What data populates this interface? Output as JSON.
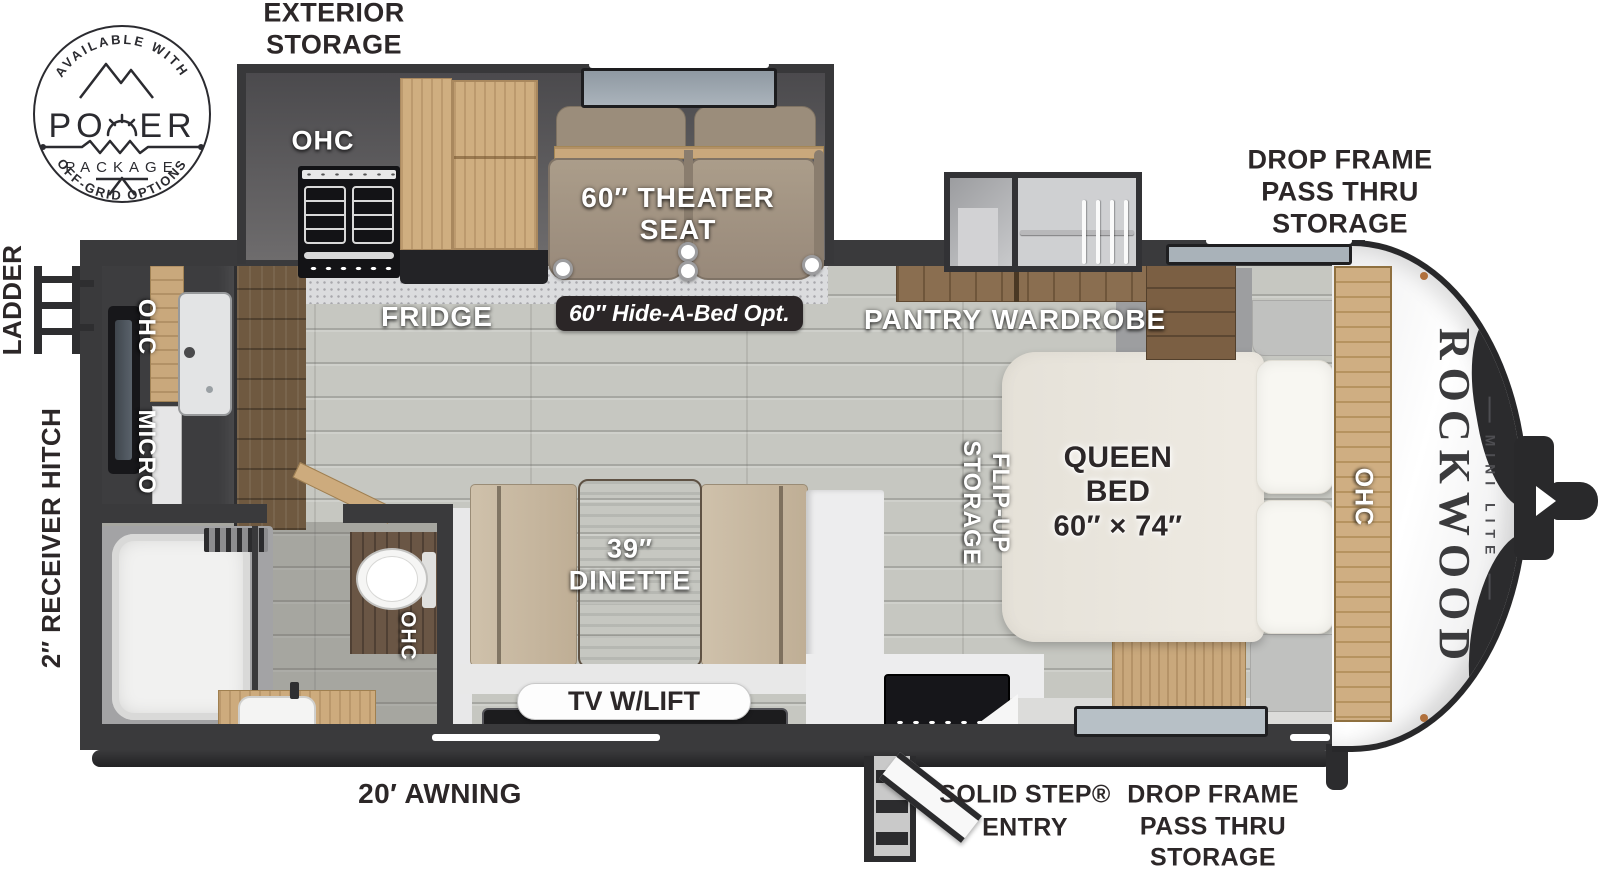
{
  "logo": {
    "arc_top": "AVAILABLE WITH",
    "power_left": "PO",
    "power_right": "ER",
    "package": "PACKAGE",
    "arc_bottom": "OFF-GRID OPTIONS"
  },
  "exterior": {
    "exterior_storage_line1": "EXTERIOR",
    "exterior_storage_line2": "STORAGE",
    "drop_frame_top_line1": "DROP FRAME",
    "drop_frame_top_line2": "PASS THRU",
    "drop_frame_top_line3": "STORAGE",
    "drop_frame_bottom_line1": "DROP FRAME",
    "drop_frame_bottom_line2": "PASS THRU",
    "drop_frame_bottom_line3": "STORAGE",
    "ladder": "LADDER",
    "receiver_hitch": "2″ RECEIVER HITCH",
    "awning": "20′ AWNING",
    "solid_step_line1": "SOLID STEP®",
    "solid_step_line2": "ENTRY"
  },
  "interior": {
    "galley_ohc": "OHC",
    "theater_line1": "60″ THEATER",
    "theater_line2": "SEAT",
    "fridge": "FRIDGE",
    "hide_a_bed": "60″ Hide-A-Bed Opt.",
    "pantry": "PANTRY",
    "wardrobe": "WARDROBE",
    "kitchen_micro": "MICRO",
    "kitchen_ohc": "OHC",
    "bath_ohc": "OHC",
    "flip_up_line1": "FLIP-UP",
    "flip_up_line2": "STORAGE",
    "queen_line1": "QUEEN",
    "queen_line2": "BED",
    "queen_line3": "60″ × 74″",
    "bed_ohc": "OHC",
    "dinette_line1": "39″",
    "dinette_line2": "DINETTE",
    "tv_lift": "TV W/LIFT"
  },
  "branding": {
    "brand": "ROCKWOOD",
    "model": "MINI LITE"
  },
  "colors": {
    "wall": "#3a3a3c",
    "badge": "#2b2627",
    "floor": "#c6c7c1",
    "wood": "#cfae80",
    "label_dark": "#2c2728"
  }
}
